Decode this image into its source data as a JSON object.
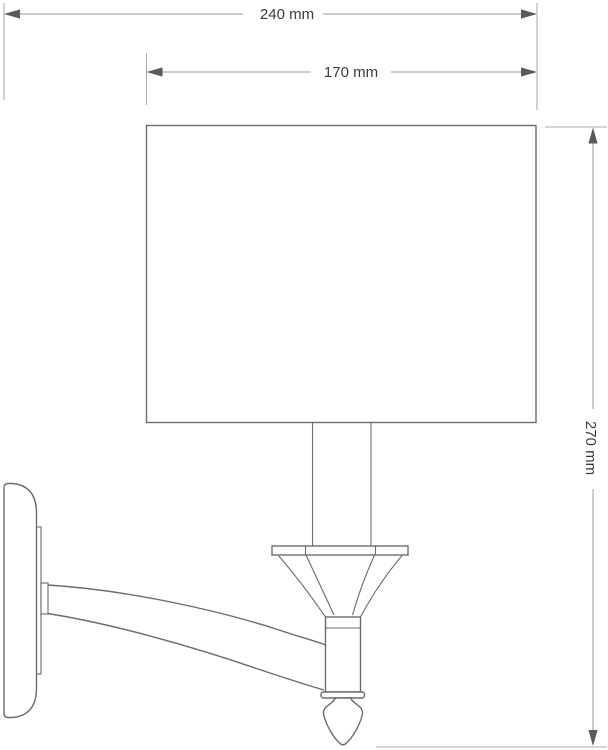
{
  "title": "Wall sconce dimensional drawing",
  "dimensions": {
    "overall_width": {
      "label": "240 mm",
      "value": 240,
      "unit": "mm"
    },
    "shade_width": {
      "label": "170 mm",
      "value": 170,
      "unit": "mm"
    },
    "overall_height": {
      "label": "270 mm",
      "value": 270,
      "unit": "mm"
    }
  },
  "colors": {
    "background": "#ffffff",
    "outline": "#6b6b6b",
    "dimension_line": "#adadad",
    "arrow": "#5a5a5a",
    "text": "#3a3a3a"
  }
}
